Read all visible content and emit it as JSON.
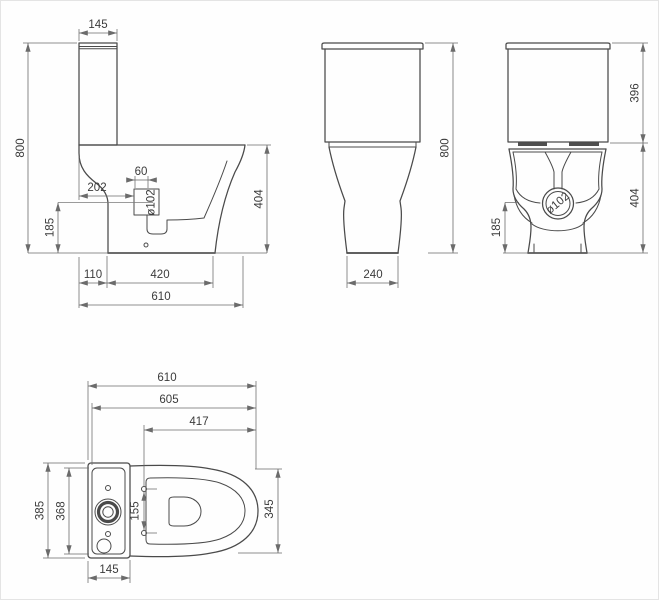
{
  "drawing": {
    "kind": "sanitaryware technical dimension drawing",
    "views": {
      "side": {
        "title": "side elevation"
      },
      "front": {
        "title": "front elevation"
      },
      "rear": {
        "title": "rear elevation"
      },
      "plan": {
        "title": "plan view"
      }
    }
  },
  "side_view": {
    "cistern_depth": "145",
    "overall_height": "800",
    "rear_to_outlet": "202",
    "outlet_stub_width": "60",
    "outlet_diameter": "ø102",
    "outlet_center_height": "185",
    "rear_gap": "110",
    "foot_depth": "420",
    "overall_depth": "610",
    "rim_height": "404"
  },
  "front_view": {
    "overall_height": "800",
    "foot_width": "240"
  },
  "rear_view": {
    "cistern_height": "396",
    "outlet_diameter": "ø102",
    "outlet_center_height": "185",
    "bowl_height": "404"
  },
  "plan_view": {
    "overall_depth": "610",
    "body_depth": "605",
    "hinge_to_front": "417",
    "cistern_width": "385",
    "lid_width": "368",
    "hinge_hole_spacing": "155",
    "seat_width": "345",
    "cistern_depth": "145"
  }
}
